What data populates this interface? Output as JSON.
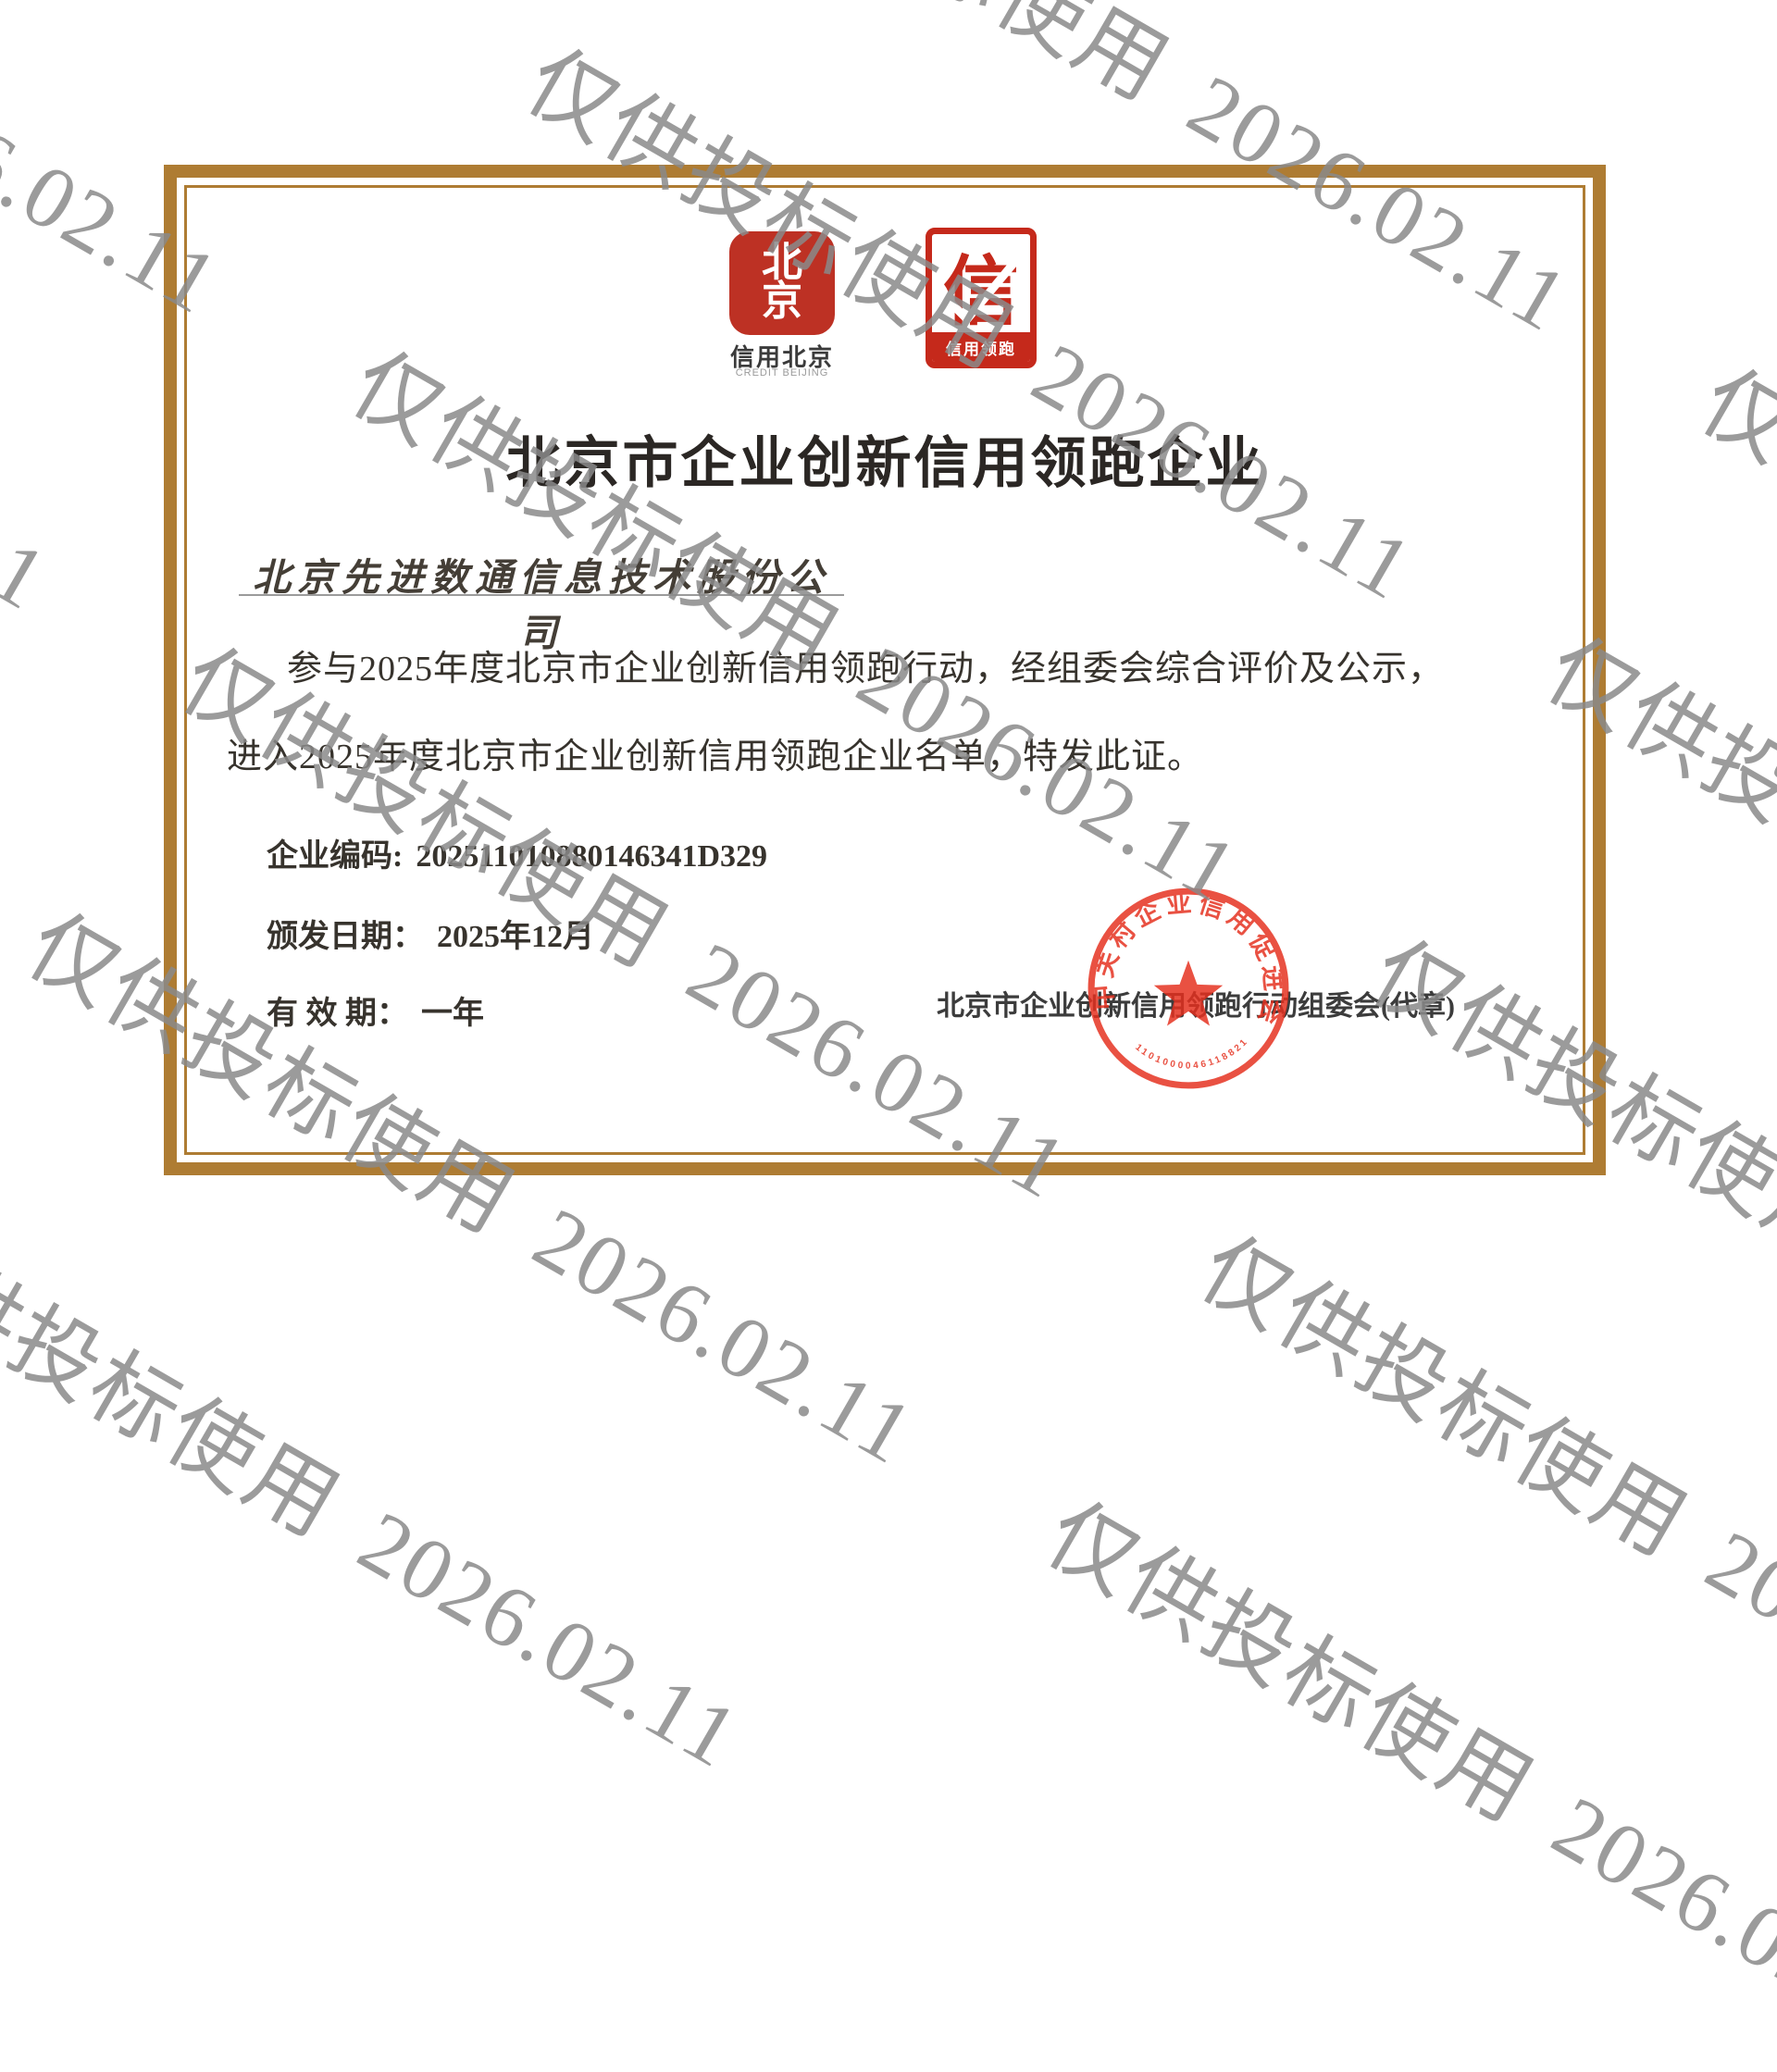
{
  "watermark": {
    "text": "仅供投标使用 2026.02.11"
  },
  "logos": {
    "credit_beijing": {
      "glyph_top": "北",
      "glyph_bottom": "京",
      "label_cn": "信用北京",
      "label_en": "CREDIT BEIJING"
    },
    "credit_leader": {
      "glyph": "信",
      "label": "信用领跑"
    }
  },
  "certificate": {
    "title": "北京市企业创新信用领跑企业",
    "company_name": "北京先进数通信息技术股份公司",
    "body_line1": "参与2025年度北京市企业创新信用领跑行动，经组委会综合评价及公示，",
    "body_line2": "进入2025年度北京市企业创新信用领跑企业名单，特发此证。",
    "fields": [
      {
        "label": "企业编码:",
        "value": "202511010880146341D329"
      },
      {
        "label": "颁发日期：",
        "value": "2025年12月"
      },
      {
        "label": "有 效 期：",
        "value": "一年"
      }
    ],
    "issuer": "北京市企业创新信用领跑行动组委会(代章)",
    "seal": {
      "arc_text": "中关村企业信用促进会",
      "serial": "1101000046118821"
    }
  },
  "colors": {
    "frame_brown": "#ae7c33",
    "logo_red": "#bd3124",
    "seal_red": "#e5301f",
    "watermark_gray": "#8a8a8a"
  }
}
